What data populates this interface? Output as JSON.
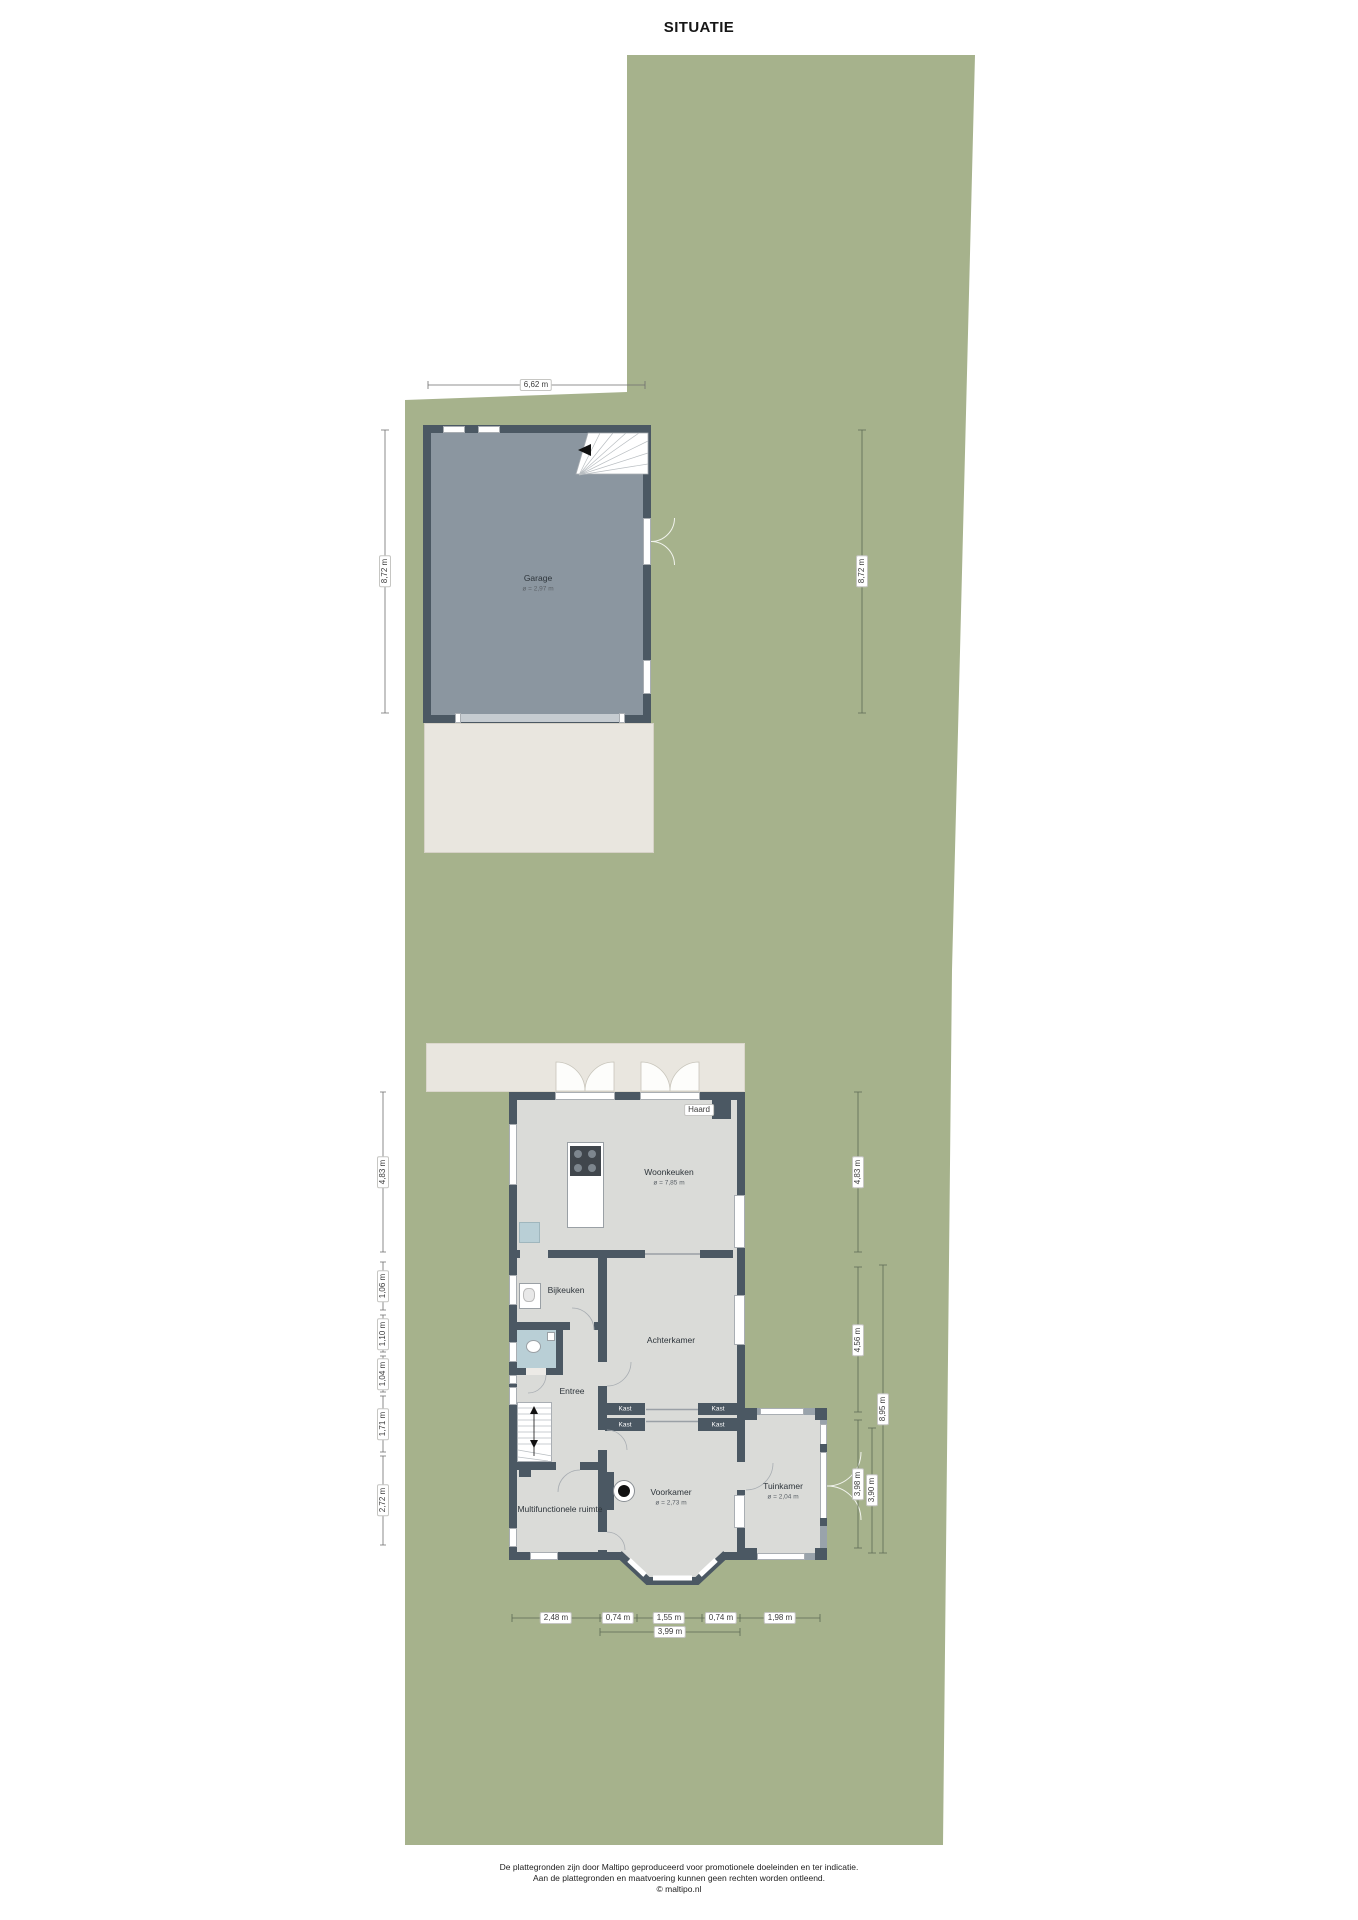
{
  "title": "SITUATIE",
  "rooms": {
    "garage": {
      "name": "Garage",
      "size": "ø = 2,97 m"
    },
    "woonkeuken": {
      "name": "Woonkeuken",
      "size": "ø = 7,85 m"
    },
    "bijkeuken": {
      "name": "Bijkeuken"
    },
    "achterkamer": {
      "name": "Achterkamer"
    },
    "entree": {
      "name": "Entree"
    },
    "voorkamer": {
      "name": "Voorkamer",
      "size": "ø = 2,73 m"
    },
    "tuinkamer": {
      "name": "Tuinkamer",
      "size": "ø = 2,04 m"
    },
    "multifunctionele": {
      "name": "Multifunctionele ruimte"
    },
    "haard": "Haard",
    "kast": "Kast"
  },
  "dimensions": {
    "garage_width": "6,62 m",
    "garage_height_left": "8,72 m",
    "garage_height_right": "8,72 m",
    "house_left": [
      "4,83 m",
      "1,06 m",
      "1,10 m",
      "1,04 m",
      "1,71 m",
      "2,72 m"
    ],
    "house_right": [
      "4,83 m",
      "4,56 m",
      "3,98 m",
      "3,90 m",
      "8,95 m"
    ],
    "house_bottom": [
      "2,48 m",
      "0,74 m",
      "1,55 m",
      "0,74 m",
      "1,98 m"
    ],
    "house_bottom_total": "3,99 m"
  },
  "footer": [
    "De plattegronden zijn door Maltipo geproduceerd voor promotionele doeleinden en ter indicatie.",
    "Aan de plattegronden en maatvoering kunnen geen rechten worden ontleend.",
    "© maltipo.nl"
  ],
  "colors": {
    "garden": "#a6b28c",
    "wall": "#4b5863",
    "garage_floor": "#8b96a0",
    "room_floor": "#dadbd8",
    "terrace": "#e9e6df",
    "wet_room": "#b9cfd6",
    "twall": "#99a3ab"
  }
}
